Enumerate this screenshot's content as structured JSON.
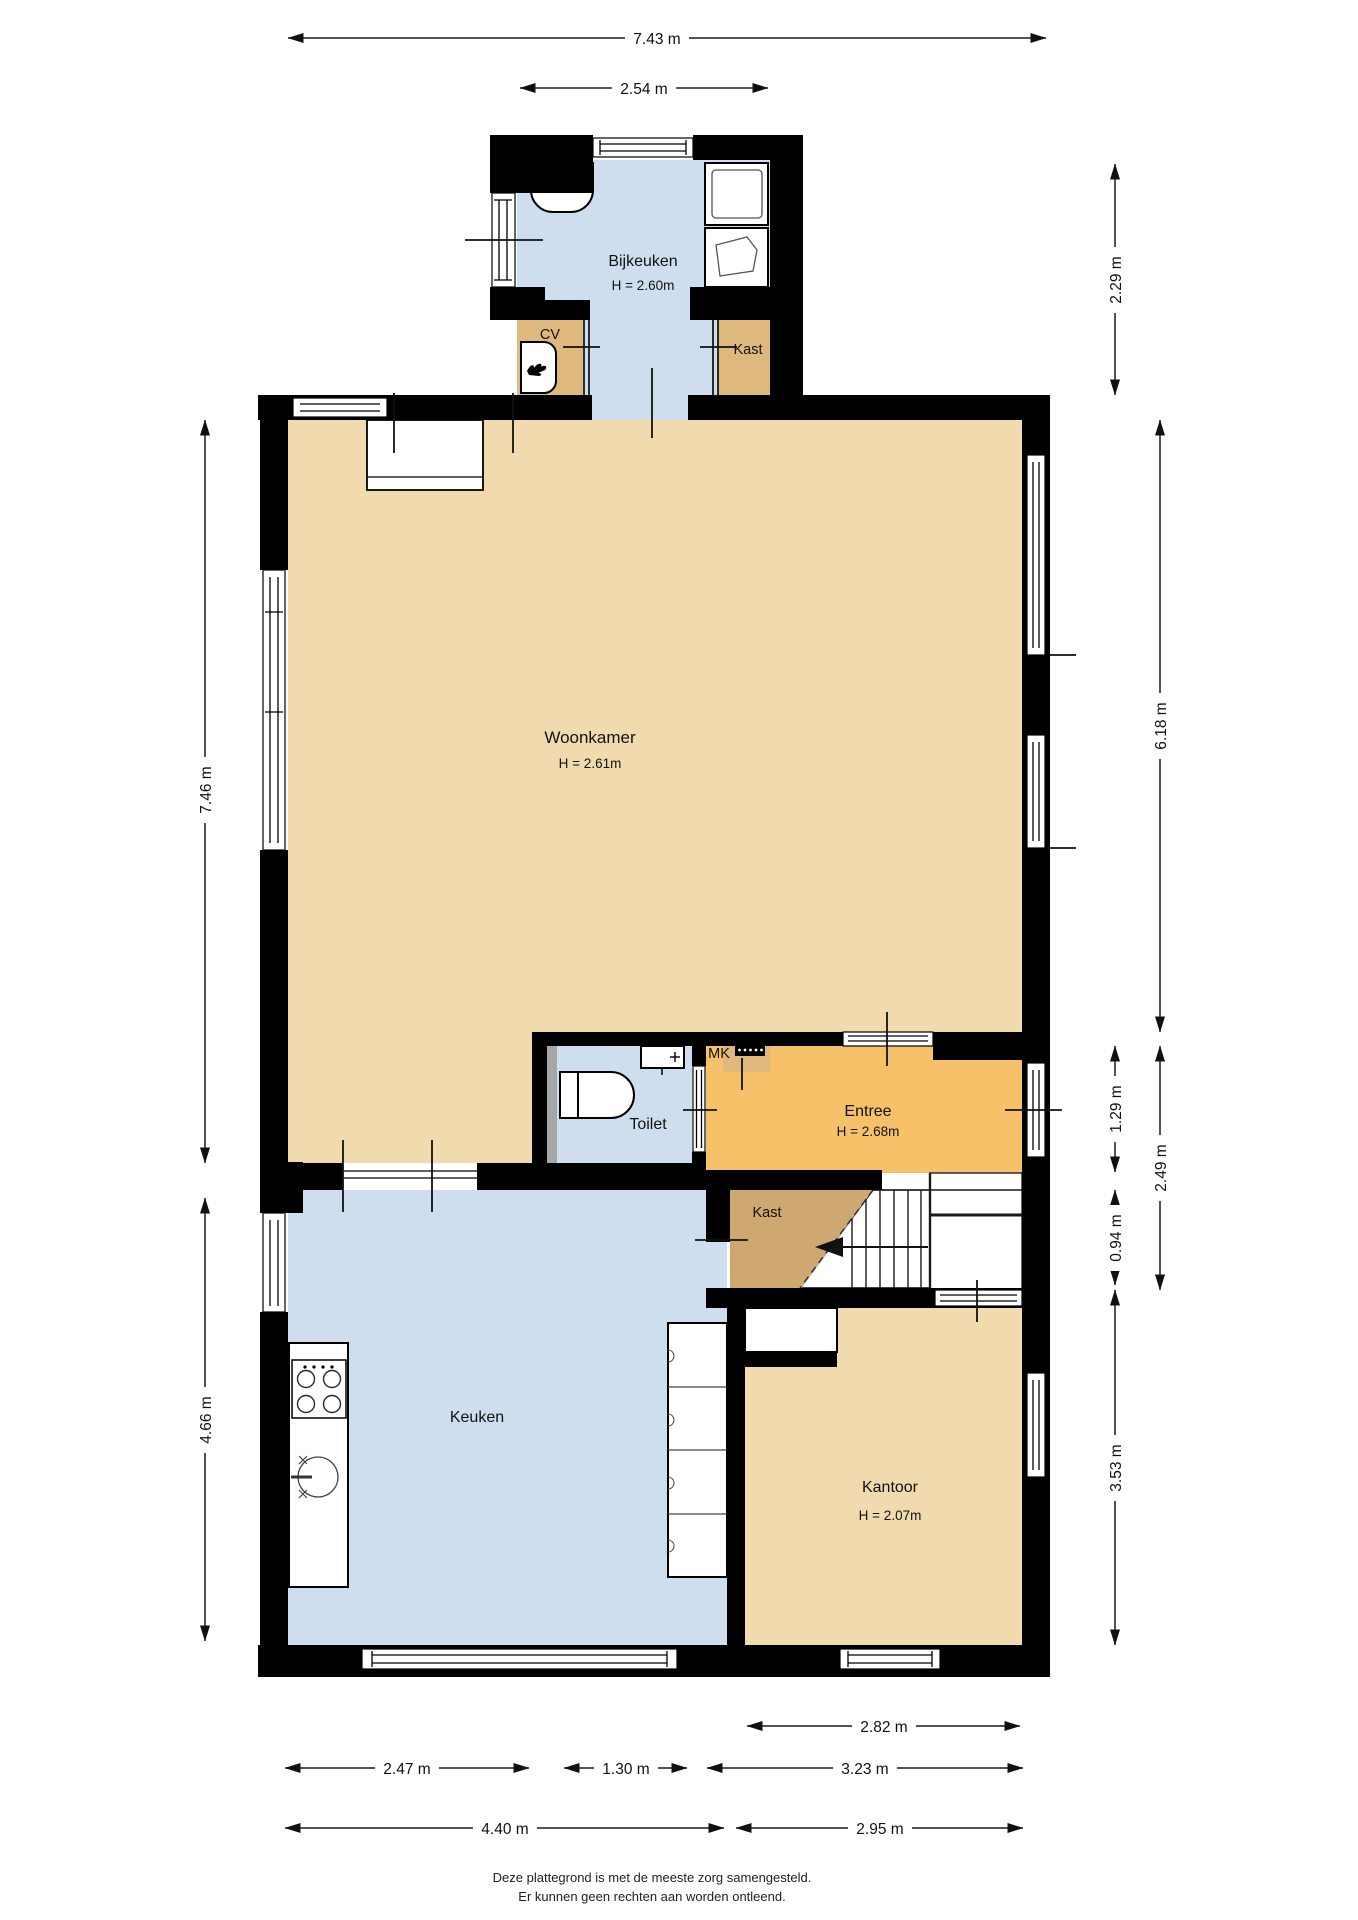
{
  "colors": {
    "wall": "#000000",
    "floor_wheat": "#f1dbae",
    "floor_blue": "#cfdeee",
    "floor_orange": "#f6c169",
    "floor_brown": "#cfa770",
    "floor_tan": "#dfb87e",
    "pillar_gray": "#a6a6a6",
    "background": "#ffffff"
  },
  "rooms": {
    "bijkeuken": {
      "name": "Bijkeuken",
      "height": "H = 2.60m"
    },
    "cv": {
      "name": "CV"
    },
    "kast_top": {
      "name": "Kast"
    },
    "woonkamer": {
      "name": "Woonkamer",
      "height": "H = 2.61m"
    },
    "toilet": {
      "name": "Toilet"
    },
    "mk": {
      "name": "MK"
    },
    "entree": {
      "name": "Entree",
      "height": "H = 2.68m"
    },
    "kast_mid": {
      "name": "Kast"
    },
    "keuken": {
      "name": "Keuken"
    },
    "kantoor": {
      "name": "Kantoor",
      "height": "H = 2.07m"
    }
  },
  "dimensions": {
    "top": {
      "total_width": "7.43 m",
      "bijkeuken_width": "2.54 m"
    },
    "left": {
      "woonkamer_side": "7.46 m",
      "keuken_side": "4.66 m"
    },
    "right": {
      "bijkeuken_depth": "2.29 m",
      "woonkamer_depth": "6.18 m",
      "entree_depth": "1.29 m",
      "entree_kast_depth": "2.49 m",
      "kast_row_depth": "0.94 m",
      "kantoor_depth": "3.53 m"
    },
    "bottom": {
      "kantoor_inner_width": "2.82 m",
      "keuken_left_width": "2.47 m",
      "toilet_width": "1.30 m",
      "entree_stairs_width": "3.23 m",
      "keuken_total_width": "4.40 m",
      "kantoor_width": "2.95 m"
    }
  },
  "footer": {
    "line1": "Deze plattegrond is met de meeste zorg samengesteld.",
    "line2": "Er kunnen geen rechten aan worden ontleend."
  }
}
